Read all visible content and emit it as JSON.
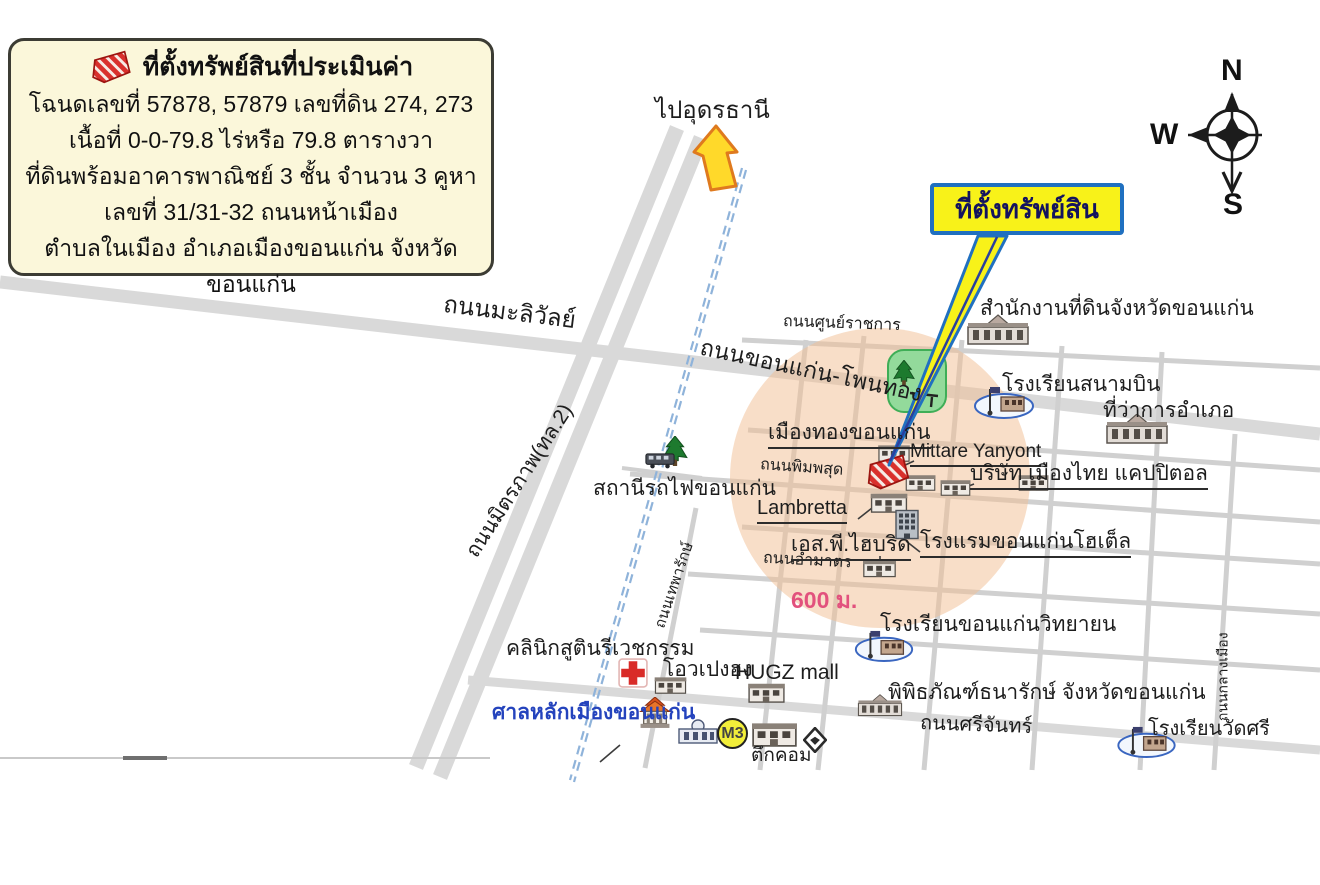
{
  "legend": {
    "title": "ที่ตั้งทรัพย์สินที่ประเมินค่า",
    "lines": [
      "โฉนดเลขที่ 57878, 57879 เลขที่ดิน 274, 273",
      "เนื้อที่  0-0-79.8 ไร่หรือ 79.8 ตารางวา",
      "ที่ดินพร้อมอาคารพาณิชย์ 3 ชั้น จำนวน 3 คูหา",
      "เลขที่ 31/31-32 ถนนหน้าเมือง",
      "ตำบลในเมือง  อำเภอเมืองขอนแก่น จังหวัดขอนแก่น"
    ]
  },
  "callout": {
    "label": "ที่ตั้งทรัพย์สิน"
  },
  "signs": {
    "to_udon": "ไปอุดรธานี",
    "distance": "600 ม."
  },
  "compass": {
    "north": "N",
    "west": "W",
    "south": "S"
  },
  "roads": {
    "maliwan": "ถนนมะลิวัลย์",
    "mittraphap": "ถนนมิตรภาพ(ทล.2)",
    "sun_ratchakan": "ถนนศูนย์ราชการ",
    "khonkaen_phonthong": "ถนนขอนแก่น-โพนทอง",
    "phimphasut": "ถนนพิมพสุด",
    "ammat": "ถนนอำมาตร",
    "srichan": "ถนนศรีจันทร์",
    "klang_mueang": "ถนนกลางเมือง",
    "thepharak": "ถนนเทพารักษ์"
  },
  "places": {
    "railway_station": "สถานีรถไฟขอนแก่น",
    "land_office": "สำนักงานที่ดินจังหวัดขอนแก่น",
    "school_sanambin": "โรงเรียนสนามบิน",
    "district_office": "ที่ว่าการอำเภอ",
    "mueangthong": "เมืองทองขอนแก่น",
    "mittare_yanyont": "Mittare Yanyont",
    "muangthai_capitol": "บริษัท เมืองไทย แคปปิตอล",
    "lambretta": "Lambretta",
    "khonkaen_hotel": "โรงแรมขอนแก่นโฮเต็ล",
    "sp_hybrid": "เอส.พี.ไฮบริด",
    "school_kkw": "โรงเรียนขอนแก่นวิทยายน",
    "treasury_museum": "พิพิธภัณฑ์ธนารักษ์ จังหวัดขอนแก่น",
    "school_watsri": "โรงเรียนวัดศรี",
    "clinic": "คลินิกสูตินรีเวชกรรม",
    "o_peng_hong": "โอวเปงฮง",
    "hugz_mall": "HUGZ mall",
    "city_pillar": "ศาลหลักเมืองขอนแก่น",
    "tuk_com": "ตึกคอม"
  },
  "badges": {
    "m3": "M3"
  },
  "icons": {
    "property_marker": "red-hatched-parcel",
    "direction_arrow": "yellow-up-arrow",
    "park": "tree-and-bench",
    "schools": "flag-building-in-oval",
    "clinic": "red-cross",
    "railway": "blue-dashed-line"
  },
  "colors": {
    "legend_bg": "#fbf7da",
    "callout_yellow": "#f8f219",
    "callout_border_blue": "#2070c0",
    "marker_red": "#d9302c",
    "park_green": "#93da9b",
    "radius_orange": "#f2bd92",
    "railway_blue": "#8fb3da",
    "road_gray": "#d9d9d9",
    "distance_pink": "#e2517d",
    "city_pillar_blue": "#2443bd",
    "arrow_yellow": "#ffd92a",
    "arrow_border_orange": "#df7a1e"
  }
}
